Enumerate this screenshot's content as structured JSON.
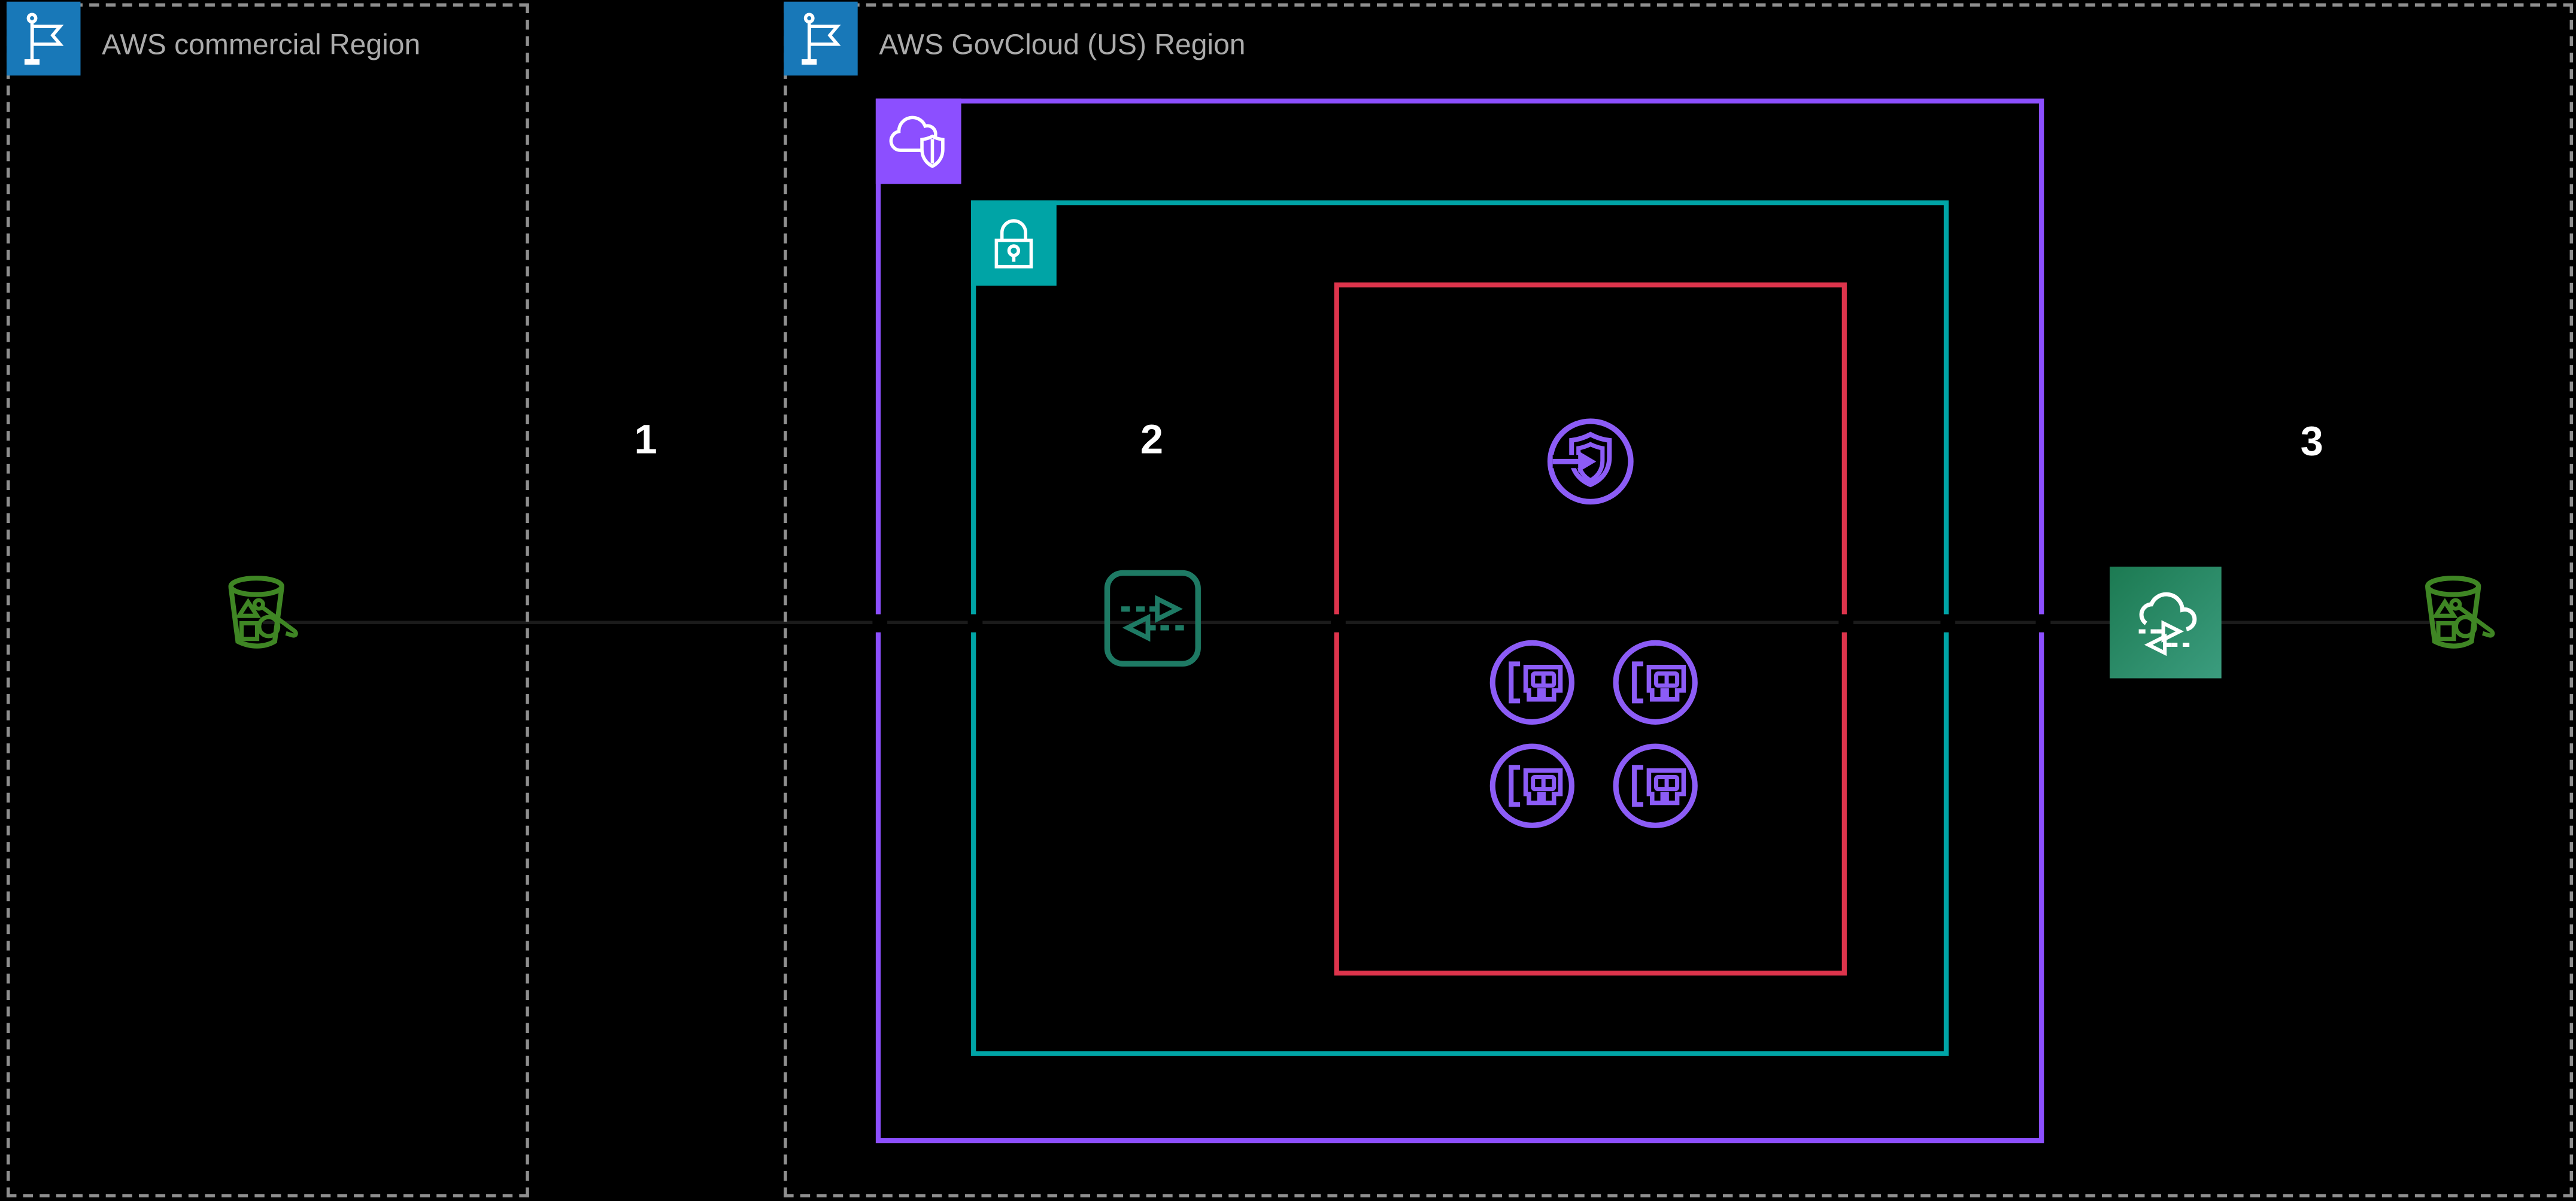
{
  "background": "#000000",
  "regions": [
    {
      "id": "aws-commercial",
      "label": "AWS commercial Region"
    },
    {
      "id": "aws-govcloud",
      "label": "AWS GovCloud (US) Region"
    }
  ],
  "steps": [
    "1",
    "2",
    "3"
  ],
  "containers": {
    "vpc": {
      "name": "virtual-private-cloud",
      "color": "#8C4FFF"
    },
    "private_subnet": {
      "name": "private-subnet",
      "color": "#00A4A6"
    },
    "security_group": {
      "name": "security-group",
      "color": "#DD344C"
    }
  },
  "icons": {
    "region_flag": {
      "name": "region-flag-icon",
      "color": "#1878B8"
    },
    "s3_bucket_commercial": {
      "name": "s3-bucket-icon",
      "color": "#3F8624"
    },
    "s3_bucket_govcloud": {
      "name": "s3-bucket-icon",
      "color": "#3F8624"
    },
    "datasync_agent": {
      "name": "datasync-agent-icon",
      "color": "#1E7A64"
    },
    "vpc_endpoint": {
      "name": "vpc-endpoint-icon",
      "color": "#8C5CF6"
    },
    "elastic_network_interface": {
      "name": "elastic-network-interface-icon",
      "color": "#8C5CF6",
      "count": 4
    },
    "datasync_service": {
      "name": "datasync-icon",
      "color_start": "#1C7A52",
      "color_end": "#3B9C7E"
    }
  }
}
